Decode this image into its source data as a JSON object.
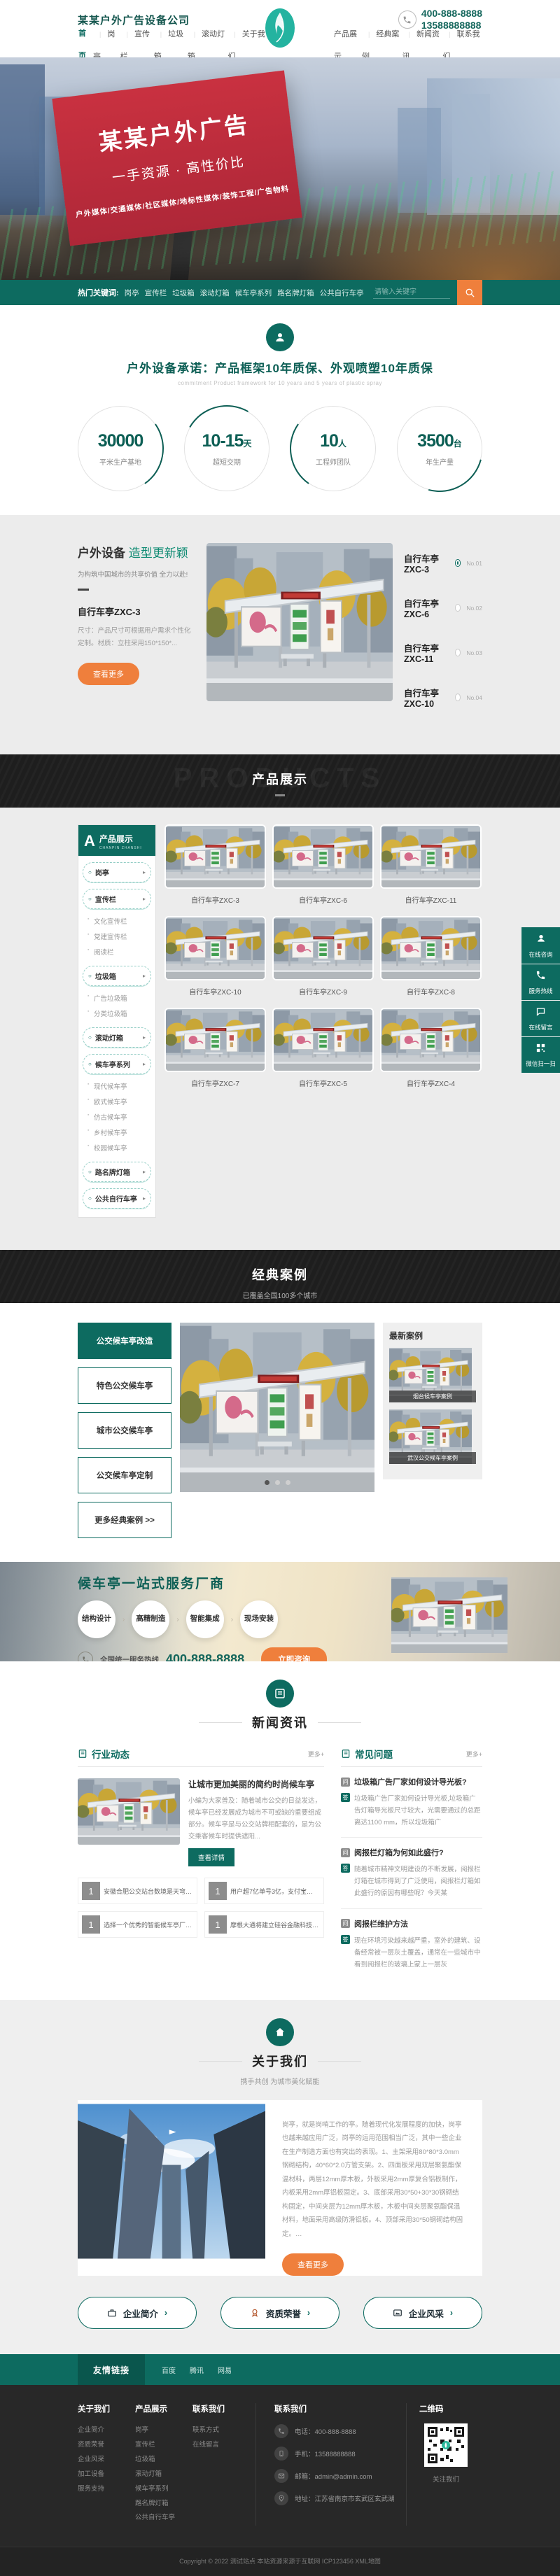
{
  "theme": {
    "teal": "#0d6b60",
    "orange": "#ef7f3c",
    "dark": "#1e1e1e",
    "red": "#c93140"
  },
  "header": {
    "company": "某某户外广告设备公司",
    "phone1": "400-888-8888",
    "phone2": "13588888888",
    "nav_left": [
      "首页",
      "岗亭",
      "宣传栏",
      "垃圾箱",
      "滚动灯箱",
      "关于我们"
    ],
    "nav_right": [
      "产品展示",
      "经典案例",
      "新闻资讯",
      "联系我们"
    ]
  },
  "hero": {
    "line1": "某某户外广告",
    "line2": "一手资源 · 高性价比",
    "line3": "户外媒体/交通媒体/社区媒体/地标性媒体/装饰工程/广告物料"
  },
  "searchbar": {
    "label": "热门关键词:",
    "keywords": [
      "岗亭",
      "宣传栏",
      "垃圾箱",
      "滚动灯箱",
      "候车亭系列",
      "路名牌灯箱",
      "公共自行车亭"
    ],
    "placeholder": "请输入关键字"
  },
  "promise": {
    "title": "户外设备承诺：产品框架10年质保、外观喷塑10年质保",
    "subtitle": "commitment Product framework for 10 years and 5 years of plastic spray",
    "stats": [
      {
        "value": "30000",
        "suffix": "",
        "label": "平米生产基地"
      },
      {
        "value": "10-15",
        "suffix": "天",
        "label": "超短交期"
      },
      {
        "value": "10",
        "suffix": "人",
        "label": "工程师团队"
      },
      {
        "value": "3500",
        "suffix": "台",
        "label": "年生产量"
      }
    ]
  },
  "equipment": {
    "title_strong": "户外设备",
    "title_light": "造型更新颖",
    "subtitle": "为构筑中国城市的共享价值 全力以赴!",
    "product_name": "自行车亭ZXC-3",
    "product_desc": "尺寸：产品尺寸可根据用户需求个性化定制。材质：立柱采用150*150*...",
    "more_btn": "查看更多",
    "list": [
      {
        "name": "自行车亭ZXC-3",
        "no": "No.01"
      },
      {
        "name": "自行车亭ZXC-6",
        "no": "No.02"
      },
      {
        "name": "自行车亭ZXC-11",
        "no": "No.03"
      },
      {
        "name": "自行车亭ZXC-10",
        "no": "No.04"
      }
    ]
  },
  "products": {
    "banner_title": "产品展示",
    "banner_watermark": "PRODUCTS",
    "sidebar_badge": "A",
    "sidebar_title": "产品展示",
    "sidebar_sub": "CHANPIN ZHANSHI",
    "menu": [
      {
        "label": "岗亭"
      },
      {
        "label": "宣传栏",
        "children": [
          "文化宣传栏",
          "党建宣传栏",
          "阅读栏"
        ]
      },
      {
        "label": "垃圾箱",
        "children": [
          "广告垃圾箱",
          "分类垃圾箱"
        ]
      },
      {
        "label": "滚动灯箱"
      },
      {
        "label": "候车亭系列",
        "children": [
          "现代候车亭",
          "欧式候车亭",
          "仿古候车亭",
          "乡村候车亭",
          "校园候车亭"
        ]
      },
      {
        "label": "路名牌灯箱"
      },
      {
        "label": "公共自行车亭"
      }
    ],
    "items": [
      "自行车亭ZXC-3",
      "自行车亭ZXC-6",
      "自行车亭ZXC-11",
      "自行车亭ZXC-10",
      "自行车亭ZXC-9",
      "自行车亭ZXC-8",
      "自行车亭ZXC-7",
      "自行车亭ZXC-5",
      "自行车亭ZXC-4"
    ]
  },
  "float_widget": [
    "在线咨询",
    "服务热线",
    "在线留言",
    "微信扫一扫"
  ],
  "cases": {
    "banner_title": "经典案例",
    "banner_subtitle": "已覆盖全国100多个城市",
    "buttons": [
      "公交候车亭改造",
      "特色公交候车亭",
      "城市公交候车亭",
      "公交候车亭定制",
      "更多经典案例 >>"
    ],
    "latest_title": "最新案例",
    "latest": [
      "烟台候车亭案例",
      "武汉公交候车亭案例"
    ]
  },
  "service": {
    "title": "候车亭一站式服务厂商",
    "steps": [
      "结构设计",
      "高精制造",
      "智能集成",
      "现场安装"
    ],
    "hotline_label": "全国统一服务热线",
    "hotline": "400-888-8888",
    "cta": "立即咨询"
  },
  "news": {
    "section_title": "新闻资讯",
    "left": {
      "title": "行业动态",
      "more": "更多+",
      "featured": {
        "title": "让城市更加美丽的简约时尚候车亭",
        "excerpt": "小编为大家普及：随着城市公交的日益发达，候车亭已经发展成为城市不可或缺的重要组成部分。候车亭是与公交站牌相配套的，是为公交乘客候车时提供遮阳...",
        "btn": "查看详情"
      },
      "items": [
        "安徽合肥公交站台数境是天穹还是人间",
        "用户超7亿单号3亿，支付宝如何令对手换...",
        "选择一个优秀的智能候车亭厂家可以从以上...",
        "摩根大通将建立硅谷金融科技园区"
      ]
    },
    "right": {
      "title": "常见问题",
      "more": "更多+",
      "faqs": [
        {
          "q": "垃圾箱广告厂家如何设计导光板?",
          "a": "垃圾箱广告厂家如何设计导光板,垃圾箱广告灯箱导光板尺寸较大，光需要通过的总距离达1100 mm，所以垃圾箱广"
        },
        {
          "q": "阅报栏灯箱为何如此盛行?",
          "a": "随着城市精神文明建设的不断发展，阅报栏灯箱在城市得到了广泛使用，阅报栏灯箱如此盛行的原因有哪些呢？今天某"
        },
        {
          "q": "阅报栏维护方法",
          "a": "现在环境污染越来越严重，室外的建筑、设备经常被一层灰土覆盖，通常在一些城市中看到阅报栏的玻璃上蒙上一层灰"
        }
      ]
    }
  },
  "about": {
    "section_title": "关于我们",
    "section_subtitle": "携手共创 为城市美化赋能",
    "text": "岗亭，就是岗哨工作的亭。随着现代化发展程度的加快，岗亭也越来越应用广泛，岗亭的运用范围相当广泛，其中一些企业在生产制造方面也有突出的表现。1、主架采用80*80*3.0mm钢砌结构，40*60*2.0方管支架。2、四面板采用双层聚氨酯保温材料，两层12mm厚木板，外板采用2mm厚复合铝板制作，内板采用2mm厚铝板固定。3、底部采用30*50+30*30钢砌结构固定，中间夹层为12mm厚木板，木板中间夹层聚氨酯保温材料，地面采用高级防滑铝板。4、顶部采用30*50钢砌结构固定。…",
    "btn": "查看更多",
    "links": [
      "企业简介",
      "资质荣誉",
      "企业风采"
    ]
  },
  "friends": {
    "label": "友情链接",
    "links": [
      "百度",
      "腾讯",
      "网易"
    ]
  },
  "footer": {
    "cols": [
      {
        "title": "关于我们",
        "links": [
          "企业简介",
          "资质荣誉",
          "企业风采",
          "加工设备",
          "服务支持"
        ]
      },
      {
        "title": "产品展示",
        "links": [
          "岗亭",
          "宣传栏",
          "垃圾箱",
          "滚动灯箱",
          "候车亭系列",
          "路名牌灯箱",
          "公共自行车亭"
        ]
      },
      {
        "title": "联系我们",
        "links": [
          "联系方式",
          "在线留言"
        ]
      }
    ],
    "contact": {
      "title": "联系我们",
      "items": [
        {
          "label": "电话：400-888-8888"
        },
        {
          "label": "手机：13588888888"
        },
        {
          "label": "邮箱：admin@admin.com"
        },
        {
          "label": "地址：江苏省南京市玄武区玄武湖"
        }
      ]
    },
    "qr_title": "二维码",
    "qr_caption": "关注我们",
    "copyright": "Copyright © 2022 测试站点 本站资源来源于互联网 ICP123456 XML地图"
  }
}
